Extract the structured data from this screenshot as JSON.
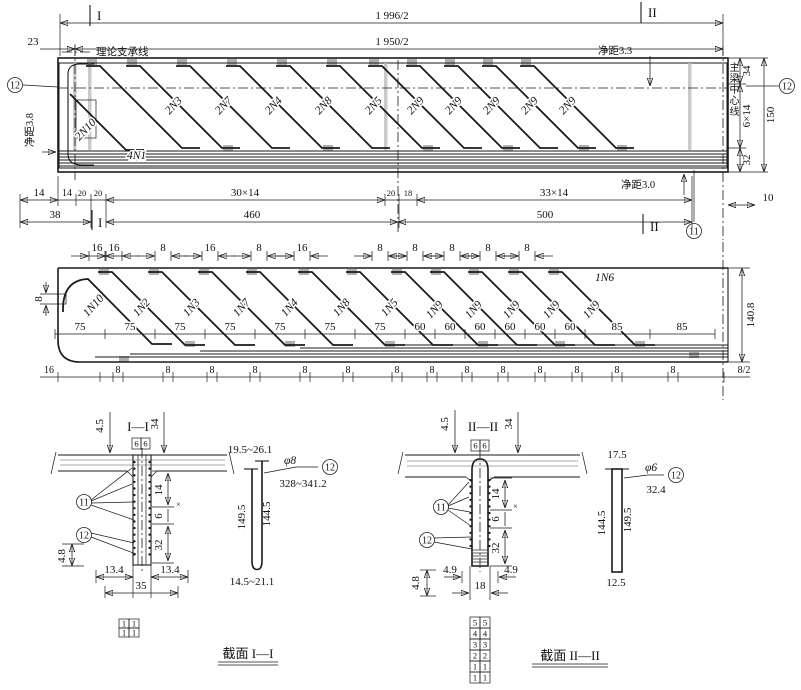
{
  "top_view": {
    "marker_top_left": "I",
    "marker_top_right": "II",
    "dim_1996": "1 996/2",
    "dim_23": "23",
    "dim_1950": "1 950/2",
    "support_line": "理论支承线",
    "clear_3_3": "净距3.3",
    "clear_3_8": "净距3.8",
    "clear_3_0": "净距3.0",
    "centerline_label": "主梁中心线",
    "callout_12_left": "12",
    "callout_12_right": "12",
    "callout_11": "11",
    "dim_34": "34",
    "dim_6x14": "6×14",
    "dim_32": "32",
    "dim_150": "150",
    "dim_10": "10",
    "bar_2n10": "2N10",
    "bar_4n1": "4N1",
    "diag_labels": [
      "2N3",
      "2N7",
      "2N4",
      "2N8",
      "2N5",
      "2N9",
      "2N9",
      "2N9",
      "2N9",
      "2N9"
    ],
    "row1": [
      "14",
      "14",
      "20",
      "20",
      "30×14",
      "20",
      "18",
      "33×14"
    ],
    "row2": [
      "38",
      "460",
      "500"
    ],
    "marker_bottom_left": "I",
    "marker_bottom_right": "II"
  },
  "lower_view": {
    "top_dims": [
      "16",
      "16",
      "8",
      "16",
      "8",
      "16",
      "8",
      "8",
      "8",
      "8",
      "8"
    ],
    "bar_1n10": "1N10",
    "bar_1n6": "1N6",
    "diag_labels": [
      "1N2",
      "1N3",
      "1N7",
      "1N4",
      "1N8",
      "1N5",
      "1N9",
      "1N9",
      "1N9",
      "1N9",
      "1N9"
    ],
    "dim_8_left": "8",
    "mid_dims": [
      "75",
      "75",
      "75",
      "75",
      "75",
      "75",
      "75",
      "60",
      "60",
      "60",
      "60",
      "60",
      "60",
      "85",
      "85"
    ],
    "bottom_dims": [
      "16",
      "8",
      "8",
      "8",
      "8",
      "8",
      "8",
      "8",
      "8",
      "8",
      "8",
      "8",
      "8",
      "8",
      "8",
      "8/2"
    ],
    "dim_140_8": "140.8"
  },
  "section_1": {
    "title": "I—I",
    "dim_4_5": "4.5",
    "dim_34": "34",
    "box_6a": "6",
    "box_6b": "6",
    "callout_11": "11",
    "callout_12": "12",
    "dim_14": "14",
    "dim_6": "6",
    "dim_x": "×",
    "dim_32": "32",
    "dim_4_8": "4.8",
    "dim_13_4a": "13.4",
    "dim_13_4b": "13.4",
    "dim_35": "35",
    "grid": [
      [
        "1",
        "1"
      ],
      [
        "1",
        "1"
      ]
    ],
    "caption": "截面 I—I"
  },
  "detail_1": {
    "dim_top": "19.5~26.1",
    "dia": "φ8",
    "callout": "12",
    "dim_len": "328~341.2",
    "dim_149_5": "149.5",
    "dim_144_5": "144.5",
    "dim_bottom": "14.5~21.1"
  },
  "section_2": {
    "title": "II—II",
    "dim_4_5": "4.5",
    "dim_34": "34",
    "box_6a": "6",
    "box_6b": "6",
    "callout_11": "11",
    "callout_12": "12",
    "dim_14": "14",
    "dim_6": "6",
    "dim_x": "×",
    "dim_32": "32",
    "dim_4_9a": "4.9",
    "dim_4_9b": "4.9",
    "dim_18": "18",
    "dim_4_8": "4.8",
    "grid": [
      [
        "5",
        "5"
      ],
      [
        "4",
        "4"
      ],
      [
        "3",
        "3"
      ],
      [
        "2",
        "2"
      ],
      [
        "1",
        "1"
      ],
      [
        "1",
        "1"
      ]
    ],
    "caption": "截面 II—II"
  },
  "detail_2": {
    "dim_top": "17.5",
    "dia": "φ6",
    "callout": "12",
    "dim_len": "32.4",
    "dim_144_5": "144.5",
    "dim_149_5": "149.5",
    "dim_bottom": "12.5"
  }
}
